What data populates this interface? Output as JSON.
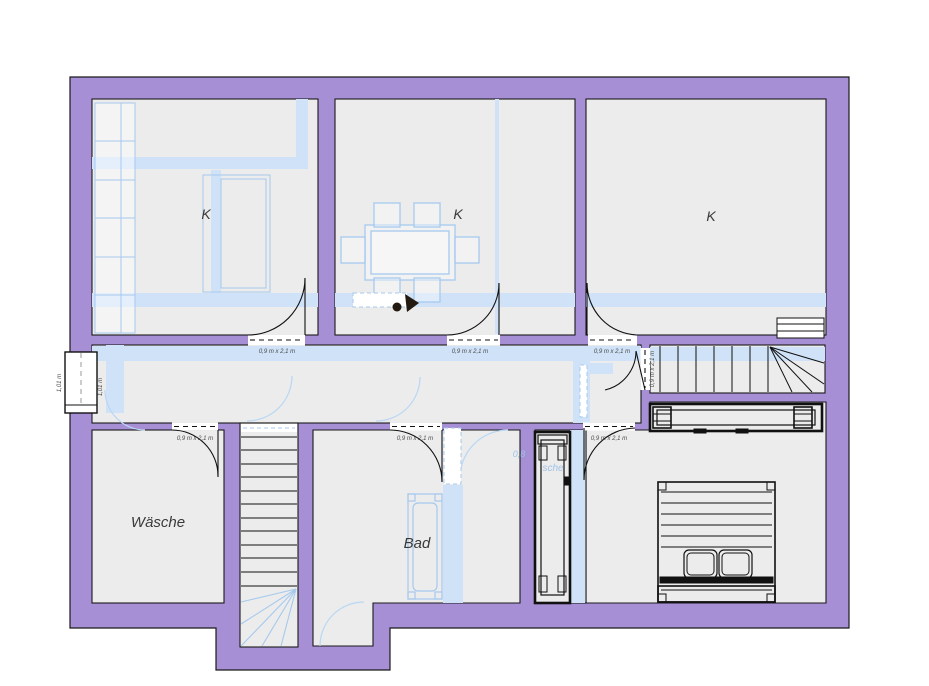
{
  "floor_plan": {
    "rooms": [
      {
        "id": "k-top-left",
        "label": "K"
      },
      {
        "id": "k-top-middle",
        "label": "K"
      },
      {
        "id": "k-top-right",
        "label": "K"
      },
      {
        "id": "waesche",
        "label": "Wäsche"
      },
      {
        "id": "bad",
        "label": "Bad"
      }
    ],
    "door_size_label": "0,9 m x 2,1 m",
    "window_label": "1,01 m",
    "lower_floor_text": {
      "part1": "0,8",
      "part2": "sche"
    },
    "colors": {
      "wall": "#a78fd5",
      "wall_outline": "#1a1a1a",
      "floor": "#ececec",
      "lower_floor_overlay": "#cfe2f7",
      "lower_floor_line": "#a6c9ee",
      "drawing_line": "#111111"
    }
  }
}
